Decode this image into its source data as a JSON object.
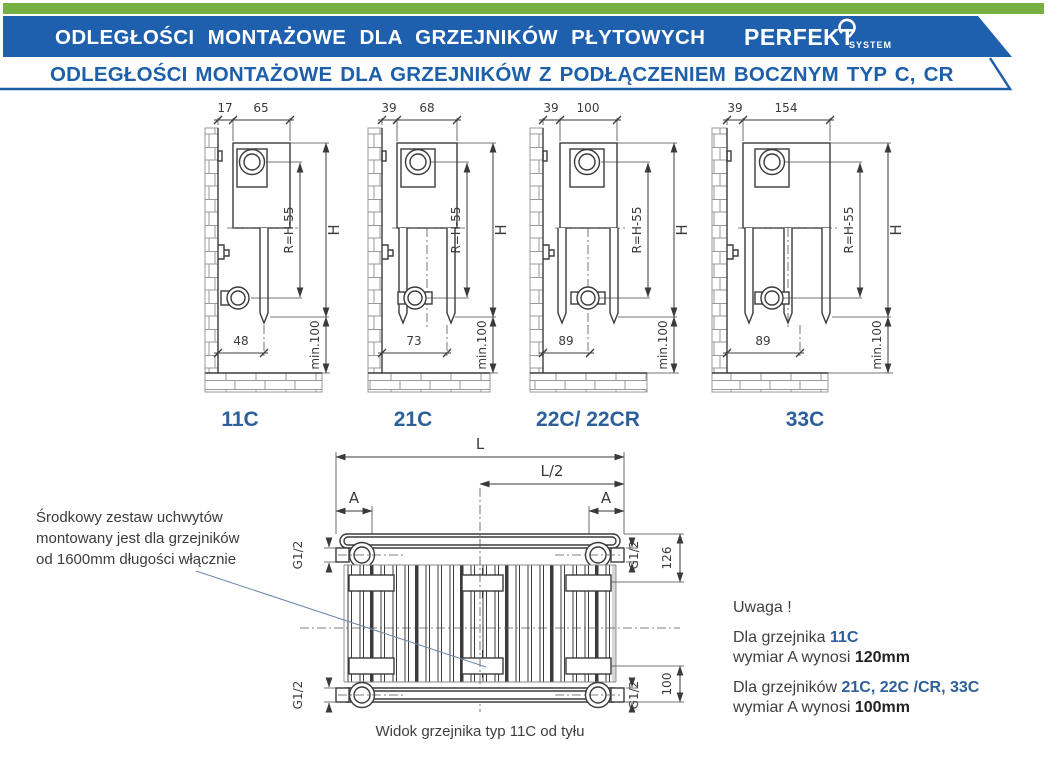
{
  "header": {
    "title": "ODLEGŁOŚCI MONTAŻOWE DLA GRZEJNIKÓW PŁYTOWYCH",
    "subtitle": "ODLEGŁOŚCI MONTAŻOWE DLA GRZEJNIKÓW Z PODŁĄCZENIEM BOCZNYM TYP C, CR",
    "brand_name": "PERFEKT",
    "brand_suffix": "SYSTEM",
    "colors": {
      "green": "#76b043",
      "blue": "#1e5fae",
      "text_blue": "#1d5fa9",
      "label_blue": "#2d5f9a"
    }
  },
  "diagrams": [
    {
      "label": "11C",
      "dim_gap": "17",
      "dim_depth": "65",
      "dim_bottom": "48",
      "dim_radius": "R=H-55",
      "dim_height": "H",
      "dim_min": "min.100"
    },
    {
      "label": "21C",
      "dim_gap": "39",
      "dim_depth": "68",
      "dim_bottom": "73",
      "dim_radius": "R=H-55",
      "dim_height": "H",
      "dim_min": "min.100"
    },
    {
      "label": "22C/ 22CR",
      "dim_gap": "39",
      "dim_depth": "100",
      "dim_bottom": "89",
      "dim_radius": "R=H-55",
      "dim_height": "H",
      "dim_min": "min.100"
    },
    {
      "label": "33C",
      "dim_gap": "39",
      "dim_depth": "154",
      "dim_bottom": "89",
      "dim_radius": "R=H-55",
      "dim_height": "H",
      "dim_min": "min.100"
    }
  ],
  "back_view": {
    "dim_length": "L",
    "dim_half": "L/2",
    "dim_a_left": "A",
    "dim_a_right": "A",
    "thread": "G1/2",
    "dim_top": "126",
    "dim_bottom": "100",
    "caption": "Widok grzejnika typ 11C od tyłu"
  },
  "annotation": {
    "line1": "Środkowy zestaw uchwytów",
    "line2": "montowany jest dla grzejników",
    "line3": "od 1600mm długości włącznie"
  },
  "note": {
    "heading": "Uwaga !",
    "line1_prefix": "Dla grzejnika ",
    "line1_types": "11C",
    "line2_prefix": "wymiar A wynosi ",
    "line2_value": "120mm",
    "line3_prefix": "Dla grzejników ",
    "line3_types": "21C, 22C /CR, 33C",
    "line4_prefix": "wymiar A wynosi ",
    "line4_value": "100mm"
  }
}
